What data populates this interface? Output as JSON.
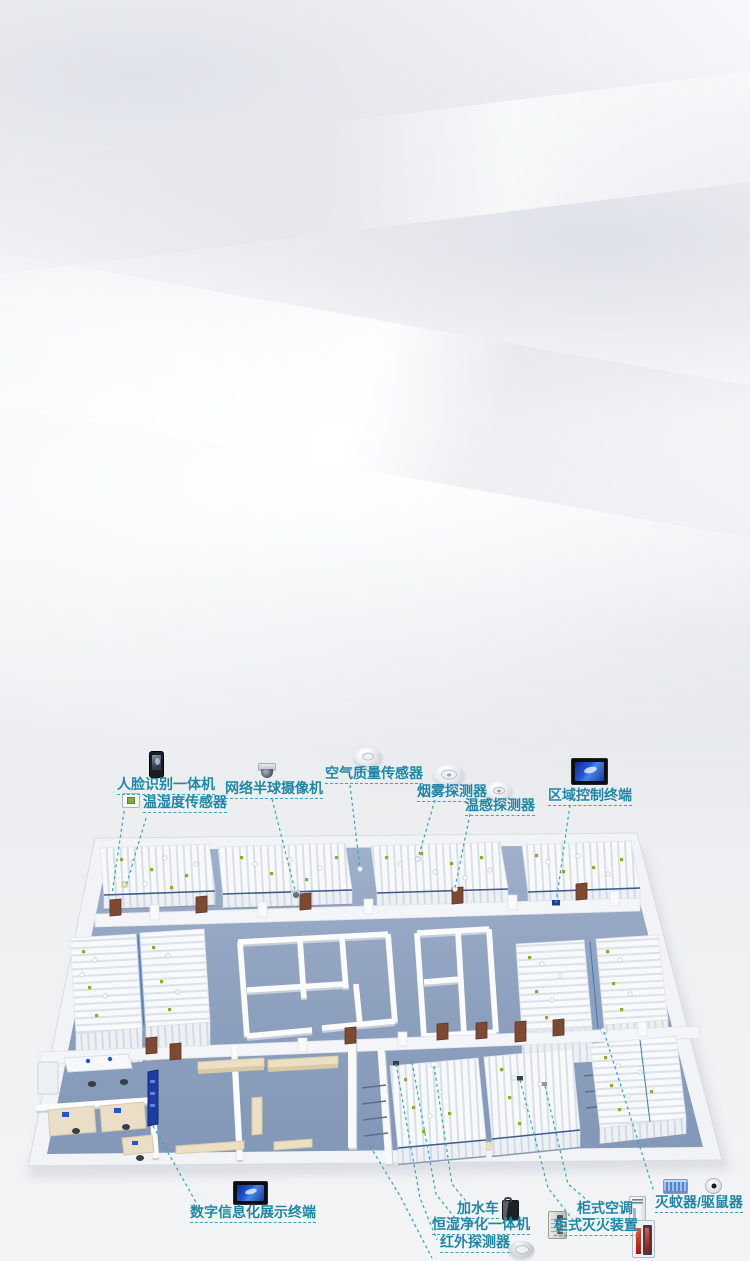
{
  "scene": {
    "type": "isometric-archive-room-infographic",
    "description": "3D floor plan of smart archive room with labeled IoT devices"
  },
  "colors": {
    "label_text": "#1d86a7",
    "callout_line": "#2ea6c6",
    "floor_blue": "#8da1c0",
    "slab_white": "#f1f3f6",
    "shelf_white": "#f7f9fb",
    "door_brown": "#7d4a31",
    "bench_tan": "#ecdfc2",
    "screen_blue": "#1d3da0",
    "dot_green": "#9aa827"
  },
  "devices": {
    "face_terminal": {
      "label": "人脸识别一体机",
      "icon": "face-recognition-terminal-icon"
    },
    "temp_humidity": {
      "label": "温湿度传感器",
      "icon": "temp-humidity-sensor-icon"
    },
    "dome_camera": {
      "label": "网络半球摄像机",
      "icon": "network-dome-camera-icon"
    },
    "air_quality": {
      "label": "空气质量传感器",
      "icon": "air-quality-sensor-icon"
    },
    "smoke_detector": {
      "label": "烟雾探测器",
      "icon": "smoke-detector-icon"
    },
    "heat_detector": {
      "label": "温感探测器",
      "icon": "heat-detector-icon"
    },
    "area_control": {
      "label": "区域控制终端",
      "icon": "area-control-terminal-icon"
    },
    "digital_display": {
      "label": "数字信息化展示终端",
      "icon": "digital-display-terminal-icon"
    },
    "water_cart": {
      "label": "加水车",
      "icon": "water-cart-icon"
    },
    "humidity_purifier": {
      "label": "恒湿净化一体机",
      "icon": "humidity-purifier-icon"
    },
    "infrared_detector": {
      "label": "红外探测器",
      "icon": "infrared-detector-icon"
    },
    "cabinet_ac": {
      "label": "柜式空调",
      "icon": "cabinet-air-conditioner-icon"
    },
    "cabinet_fire": {
      "label": "柜式灭火装置",
      "icon": "cabinet-fire-extinguisher-icon"
    },
    "mosquito_rat": {
      "label": "灭蚊器/驱鼠器",
      "icon": "mosquito-killer-rat-repeller-icon"
    }
  }
}
